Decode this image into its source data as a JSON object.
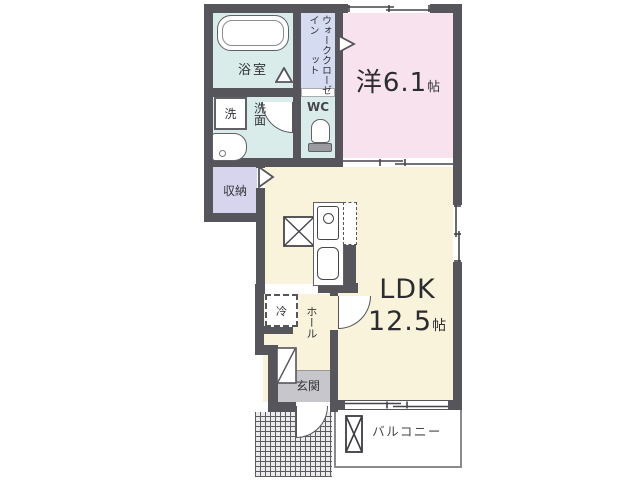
{
  "rooms": {
    "bathroom": {
      "name": "浴室"
    },
    "wic": {
      "line1": "ウォークイン",
      "line2": "クローゼット"
    },
    "western": {
      "name": "洋6.1",
      "unit": "帖"
    },
    "laundry": {
      "name": "洗"
    },
    "washroom": {
      "name": "洗面"
    },
    "wc": {
      "name": "WC"
    },
    "storage": {
      "name": "収納"
    },
    "ldk": {
      "name": "LDK",
      "size": "12.5",
      "unit": "帖"
    },
    "refrigerator": {
      "name": "冷"
    },
    "hall": {
      "name": "ホール"
    },
    "entrance": {
      "name": "玄関"
    },
    "balcony": {
      "name": "バルコニー"
    }
  },
  "colors": {
    "wall": "#55555b",
    "wet_area": "#d9ecea",
    "wic": "#d5dbf1",
    "western": "#f8e2ed",
    "storage": "#d7d4ee",
    "ldk": "#f8f3da",
    "entrance_floor": "#c7c7cb"
  }
}
